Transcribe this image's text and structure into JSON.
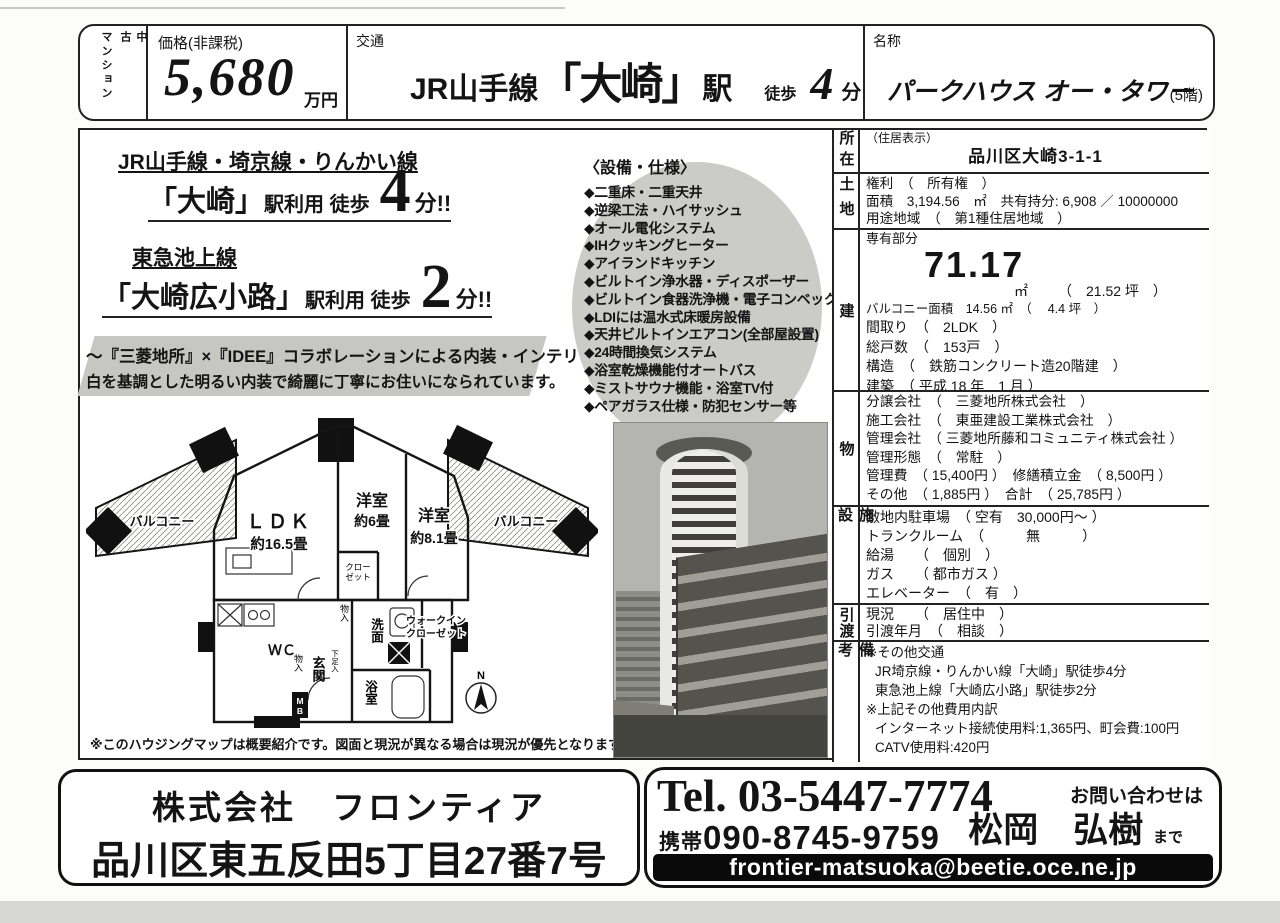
{
  "category": {
    "main": "マンション",
    "sub": "中古"
  },
  "header": {
    "price_label": "価格(非課税)",
    "price_value": "5,680",
    "price_unit": "万円",
    "transport_label": "交通",
    "transport_line": "JR山手線",
    "transport_station": "「大崎」",
    "transport_station_suffix": "駅",
    "transport_walk": "徒歩",
    "transport_minutes": "4",
    "transport_min_unit": "分",
    "name_label": "名称",
    "name_value": "パークハウス オー・タワー",
    "name_floor": "(5階)"
  },
  "access": {
    "l1_lines": "JR山手線・埼京線・りんかい線",
    "l1_station": "「大崎」",
    "l1_use": "駅利用 徒歩",
    "l1_min": "4",
    "l1_suffix": "分!!",
    "l2_lines": "東急池上線",
    "l2_station": "「大崎広小路」",
    "l2_use": "駅利用 徒歩",
    "l2_min": "2",
    "l2_suffix": "分!!"
  },
  "banner": {
    "line1": "～『三菱地所』×『IDEE』コラボレーションによる内装・インテリア ～",
    "line2": "白を基調とした明るい内装で綺麗に丁寧にお住いになられています。"
  },
  "equipment": {
    "title": "〈設備・仕様〉",
    "items": [
      "◆二重床・二重天井",
      "◆逆梁工法・ハイサッシュ",
      "◆オール電化システム",
      "◆IHクッキングヒーター",
      "◆アイランドキッチン",
      "◆ビルトイン浄水器・ディスポーザー",
      "◆ビルトイン食器洗浄機・電子コンベック",
      "◆LDIには温水式床暖房設備",
      "◆天井ビルトインエアコン(全部屋設置)",
      "◆24時間換気システム",
      "◆浴室乾燥機能付オートバス",
      "◆ミストサウナ機能・浴室TV付",
      "◆ペアガラス仕様・防犯センサー等"
    ]
  },
  "floorplan": {
    "balcony_left": "バルコニー",
    "balcony_right": "バルコニー",
    "ldk": "ＬＤＫ",
    "ldk_size": "約16.5畳",
    "room_a": "洋室",
    "room_a_size": "約6畳",
    "room_b": "洋室",
    "room_b_size": "約8.1畳",
    "closet_1": "クロー",
    "closet_2": "ゼット",
    "wic_1": "ウォークイン",
    "wic_2": "クローゼット",
    "wc": "ＷＣ",
    "entrance": "玄関",
    "storage_top": "物入",
    "storage_left": "物入",
    "shoe_box": "下足入",
    "washroom": "洗面",
    "bathroom": "浴室",
    "mb": "MB",
    "compass_n": "N",
    "note": "※このハウジングマップは概要紹介です。図面と現況が異なる場合は現況が優先となります。"
  },
  "table": {
    "s1": {
      "label": "所在",
      "l1": "（住居表示）",
      "l2": "品川区大崎3-1-1"
    },
    "s2": {
      "label": "土地",
      "l1": "権利　（　所有権　）",
      "l2": "面積　3,194.56　㎡　共有持分: 6,908 ／ 10000000",
      "l3": "用途地域　（　第1種住居地域　）"
    },
    "s3": {
      "label": "建",
      "senyu": "専有部分",
      "area": "71.17",
      "unit": "㎡",
      "tsubo": "（　21.52 坪　）",
      "balcony": "バルコニー面積　14.56 ㎡　（　 4.4 坪　）",
      "madori": "間取り　（　2LDK　）",
      "soko": "総戸数　（　153戸　）",
      "kozo": "構造　（　鉄筋コンクリート造20階建　）",
      "kenchiku": "建築　（ 平成 18 年　1 月 ）"
    },
    "s4": {
      "label": "物",
      "l1": "分譲会社　（　三菱地所株式会社　）",
      "l2": "施工会社　（　東亜建設工業株式会社　）",
      "l3": "管理会社　（ 三菱地所藤和コミュニティ株式会社 ）",
      "l4": "管理形態　（　常駐　）",
      "l5": "管理費　（ 15,400円 ）　修繕積立金　（ 8,500円 ）",
      "l6": "その他　（ 1,885円 ）　合計　（ 25,785円 ）"
    },
    "s5": {
      "label": "施設",
      "l1": "敷地内駐車場　（ 空有　30,000円～ ）",
      "l2": "トランクルーム　（　　　無　　　）",
      "l3": "給湯　　（　個別　）",
      "l4": "ガス　　（ 都市ガス ）",
      "l5": "エレベーター　（　有　）"
    },
    "s6": {
      "label": "引渡",
      "l1": "現況　　（　居住中　）",
      "l2": "引渡年月　（　相談　）"
    },
    "s7": {
      "label": "備考",
      "l1": "※その他交通",
      "l2": "JR埼京線・りんかい線「大崎」駅徒歩4分",
      "l3": "東急池上線「大崎広小路」駅徒歩2分",
      "l4": "※上記その他費用内訳",
      "l5": "インターネット接続使用料:1,365円、町会費:100円",
      "l6": "CATV使用料:420円"
    }
  },
  "footer": {
    "company": "株式会社　フロンティア",
    "address": "品川区東五反田5丁目27番7号",
    "tel": "Tel. 03-5447-7774",
    "mobile_label": "携帯",
    "mobile_number": "090-8745-9759",
    "inquiry": "お問い合わせは",
    "contact_name": "松岡　弘樹",
    "contact_suffix": "まで",
    "email": "frontier-matsuoka@beetie.oce.ne.jp"
  },
  "colors": {
    "paper": "#fcfcfa",
    "ink": "#141414",
    "banner_bg": "#c6c6c3",
    "ellipse_bg": "#cbcbc7",
    "email_bar": "#0a0a0a"
  }
}
